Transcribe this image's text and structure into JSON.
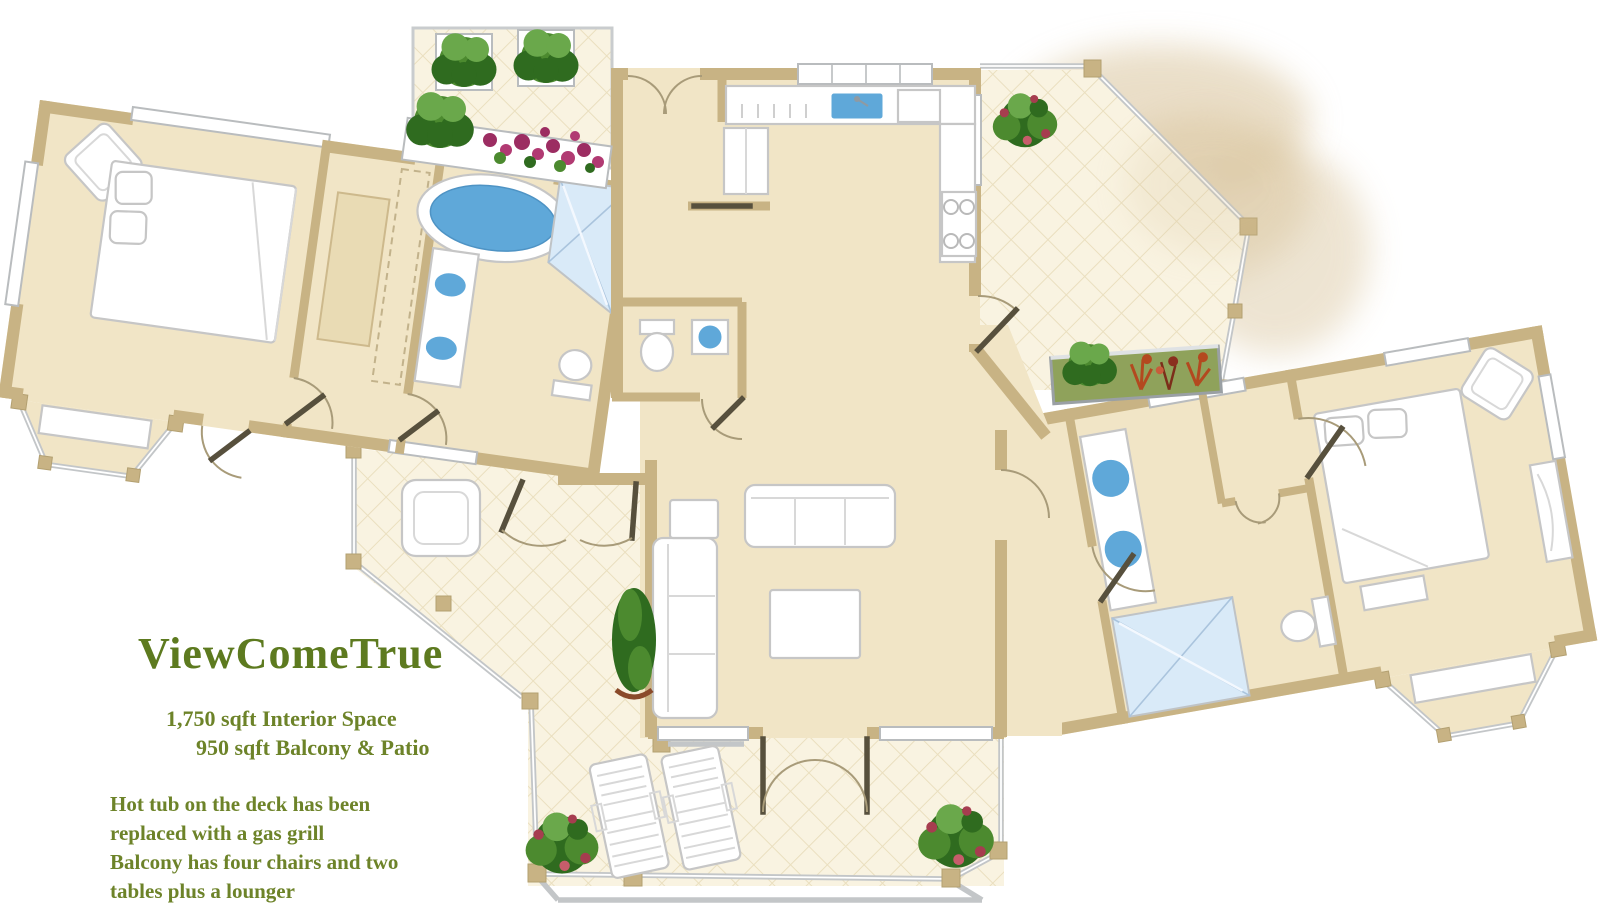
{
  "floorplan": {
    "title": "ViewComeTrue",
    "area_lines": [
      "1,750 sqft Interior Space",
      "950 sqft Balcony & Patio"
    ],
    "notes": [
      "Hot tub on the deck has been",
      "replaced with a gas grill",
      "Balcony has four chairs and two",
      "tables plus a lounger"
    ]
  },
  "palette": {
    "wall": "#c8b384",
    "floor": "#f1e5c6",
    "tile": "#f9f3e1",
    "tile-line": "#eadfbf",
    "water": "#5fa8d9",
    "shower": "#d9eaf8",
    "rail": "#c3c6c8",
    "door": "#57503d",
    "ink-title": "#5d7a1f",
    "ink-body": "#6d8329",
    "plant-dark": "#2f6b1f",
    "plant-mid": "#4c8a2f",
    "plant-light": "#6aa84b",
    "flower": "#9c2d62",
    "planter-grass": "#8fa25b",
    "island": "#e9dbb4",
    "smudge": "#d9c49c"
  }
}
